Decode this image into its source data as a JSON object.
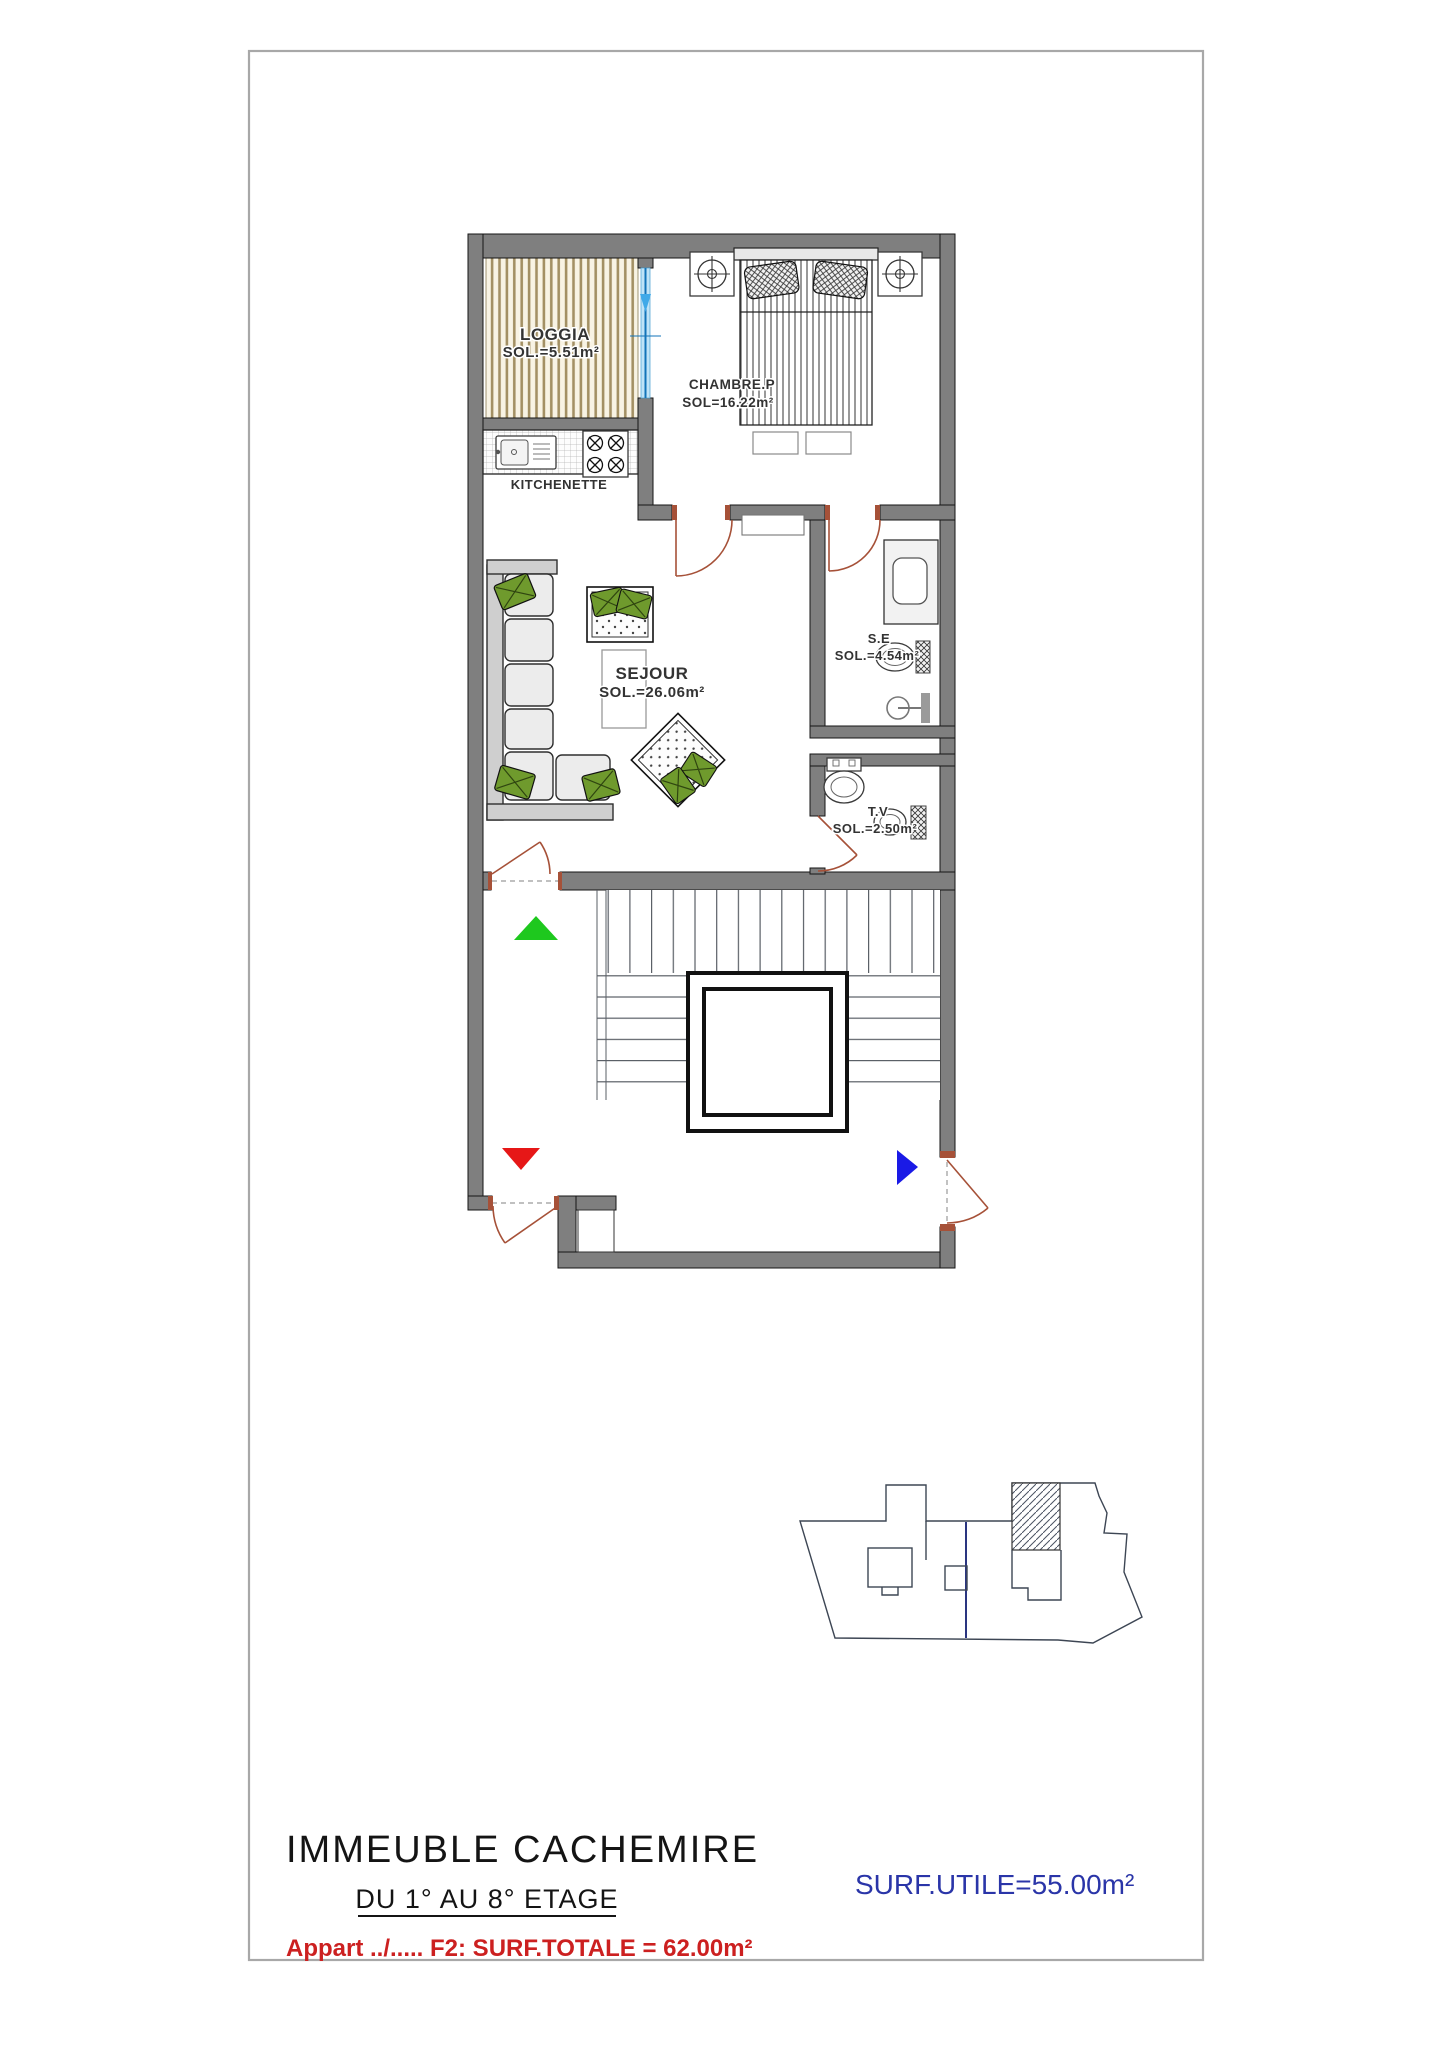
{
  "sheet": {
    "title": "IMMEUBLE  CACHEMIRE",
    "floor_range": "DU 1° AU 8° ETAGE",
    "apartment_note": "Appart ../..... F2: SURF.TOTALE = 62.00m²",
    "surface_utile": "SURF.UTILE=55.00m²"
  },
  "rooms": {
    "loggia": {
      "name": "LOGGIA",
      "area": "SOL.=5.51m²"
    },
    "chambre": {
      "name": "CHAMBRE.P",
      "area": "SOL=16.22m²"
    },
    "kitchenette": {
      "name": "KITCHENETTE"
    },
    "sejour": {
      "name": "SEJOUR",
      "area": "SOL.=26.06m²"
    },
    "salle_eau": {
      "name": "S.E",
      "area": "SOL.=4.54m²"
    },
    "toilette": {
      "name": "T.V",
      "area": "SOL.=2.50m²"
    }
  },
  "markers": {
    "stairs_up": {
      "label": "stairs-up",
      "color": "#1ec81e"
    },
    "stairs_down": {
      "label": "stairs-down",
      "color": "#e61717"
    },
    "entry_direction": {
      "label": "entry-direction",
      "color": "#1a1ae6"
    }
  },
  "colors": {
    "wall_fill": "#7f7f7f",
    "window_glass": "#3fa9e8",
    "window_frame": "#1273b8",
    "door_swing": "#a65138",
    "loggia_hatch": "#a39064",
    "pillow_green": "#6f9a2d",
    "title_text": "#141414",
    "note_red": "#cc2020",
    "surface_blue": "#2a35a8",
    "siteplan_line": "#3d4654",
    "siteplan_divider": "#2a3580"
  }
}
